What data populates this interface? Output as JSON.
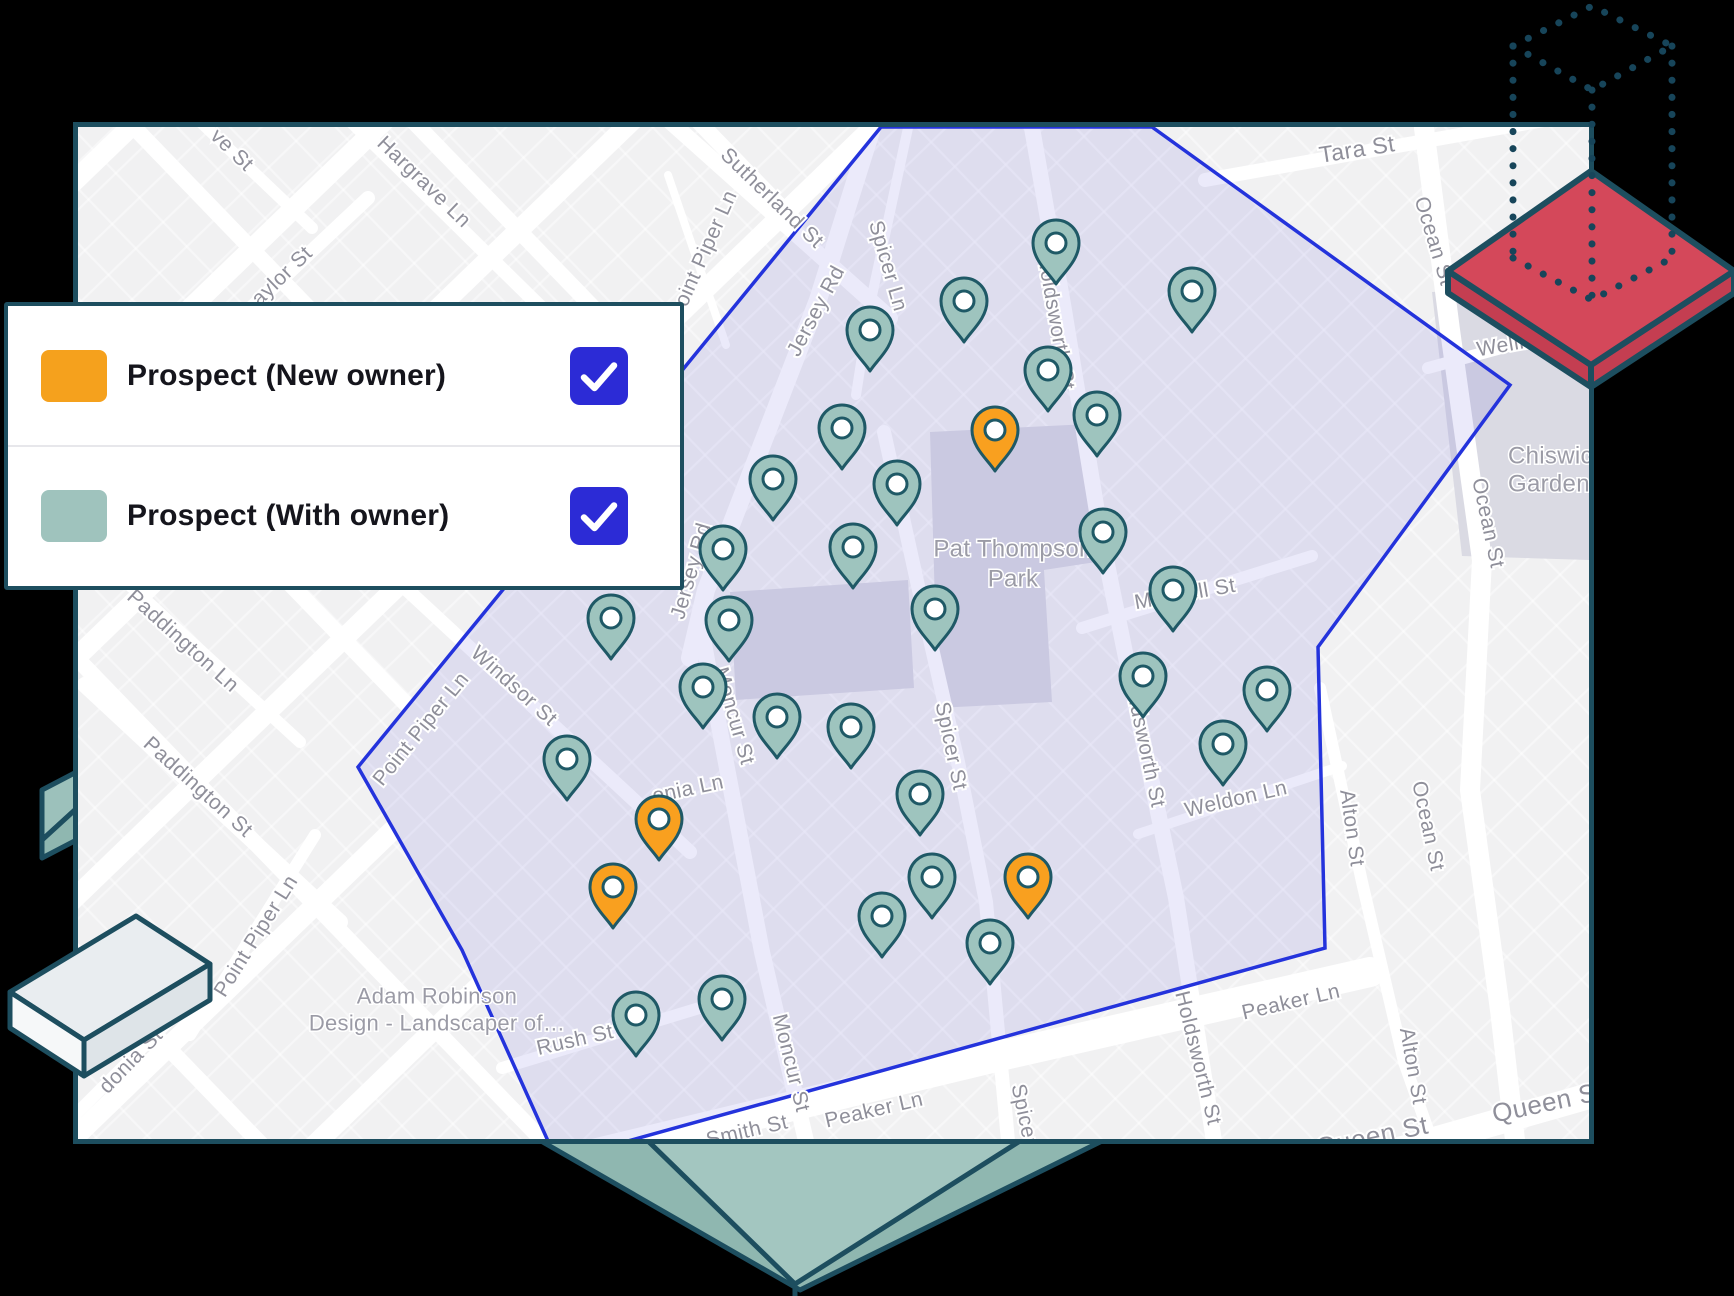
{
  "legend": {
    "items": [
      {
        "label": "Prospect (New owner)",
        "swatch_color": "#F5A11D",
        "checked": true
      },
      {
        "label": "Prospect (With owner)",
        "swatch_color": "#9FC3BD",
        "checked": true
      }
    ],
    "checkbox_color": "#2C2BD6",
    "checkmark_icon": "check"
  },
  "map": {
    "colors": {
      "base": "#F1F1F2",
      "road": "#FFFFFF",
      "park": "#DADAE3",
      "street_label": "#8F8F9A",
      "place_label": "#9B9BA6",
      "territory_fill": "rgba(98,92,216,0.13)",
      "territory_stroke": "#2433DC",
      "pin_with_owner": "#9EC4BE",
      "pin_new_owner": "#F9A01F",
      "pin_stroke": "#1F5966",
      "pin_hole": "#FFFFFF"
    },
    "territory_points": "881,127 358,767 462,950 548,1141 628,1141 1325,948 1318,647 1510,385 1152,127",
    "parks": [
      {
        "name": "pat-thompson-park",
        "points": "930,432 1088,424 1096,562 1044,570 1052,702 938,708"
      },
      {
        "name": "moncur-block",
        "points": "730,592 908,580 914,688 736,700"
      },
      {
        "name": "chiswick-gardens-block",
        "points": "1432,292 1589,282 1589,560 1462,556"
      }
    ],
    "roads": [
      {
        "pts": [
          [
            1205,
            180
          ],
          [
            1589,
            112
          ]
        ],
        "w": 14
      },
      {
        "pts": [
          [
            1424,
            128
          ],
          [
            1450,
            330
          ],
          [
            1482,
            560
          ],
          [
            1470,
            790
          ],
          [
            1500,
            1010
          ],
          [
            1515,
            1140
          ]
        ],
        "w": 20
      },
      {
        "pts": [
          [
            1300,
            1178
          ],
          [
            1589,
            1096
          ]
        ],
        "w": 26
      },
      {
        "pts": [
          [
            560,
            1162
          ],
          [
            1000,
            1056
          ],
          [
            1370,
            972
          ]
        ],
        "w": 30
      },
      {
        "pts": [
          [
            502,
            1068
          ],
          [
            706,
            1006
          ]
        ],
        "w": 12
      },
      {
        "pts": [
          [
            872,
            128
          ],
          [
            818,
            300
          ],
          [
            758,
            455
          ],
          [
            706,
            590
          ],
          [
            690,
            658
          ]
        ],
        "w": 18
      },
      {
        "pts": [
          [
            700,
            622
          ],
          [
            722,
            742
          ],
          [
            762,
            952
          ],
          [
            806,
            1141
          ]
        ],
        "w": 16
      },
      {
        "pts": [
          [
            908,
            128
          ],
          [
            870,
            305
          ],
          [
            856,
            395
          ]
        ],
        "w": 10
      },
      {
        "pts": [
          [
            884,
            432
          ],
          [
            926,
            622
          ],
          [
            958,
            762
          ],
          [
            986,
            902
          ],
          [
            1008,
            1141
          ]
        ],
        "w": 14
      },
      {
        "pts": [
          [
            1032,
            128
          ],
          [
            1064,
            310
          ],
          [
            1100,
            530
          ],
          [
            1140,
            726
          ],
          [
            1176,
            898
          ],
          [
            1214,
            1141
          ]
        ],
        "w": 16
      },
      {
        "pts": [
          [
            1138,
            834
          ],
          [
            1342,
            766
          ]
        ],
        "w": 10
      },
      {
        "pts": [
          [
            1082,
            628
          ],
          [
            1312,
            556
          ]
        ],
        "w": 12
      },
      {
        "pts": [
          [
            1428,
            368
          ],
          [
            1589,
            324
          ]
        ],
        "w": 12
      },
      {
        "pts": [
          [
            1320,
            688
          ],
          [
            1362,
            882
          ],
          [
            1404,
            1062
          ],
          [
            1432,
            1141
          ]
        ],
        "w": 12
      },
      {
        "pts": [
          [
            402,
            585
          ],
          [
            690,
            852
          ]
        ],
        "w": 14
      },
      {
        "pts": [
          [
            655,
            108
          ],
          [
            890,
            318
          ]
        ],
        "w": 16
      },
      {
        "pts": [
          [
            668,
            175
          ],
          [
            726,
            345
          ]
        ],
        "w": 8
      },
      {
        "pts": [
          [
            325,
            95
          ],
          [
            572,
            338
          ]
        ],
        "w": 14
      },
      {
        "pts": [
          [
            162,
            85
          ],
          [
            312,
            228
          ]
        ],
        "w": 12
      },
      {
        "pts": [
          [
            200,
            356
          ],
          [
            368,
            198
          ]
        ],
        "w": 14
      },
      {
        "pts": [
          [
            100,
            558
          ],
          [
            300,
            742
          ]
        ],
        "w": 12
      },
      {
        "pts": [
          [
            85,
            685
          ],
          [
            340,
            922
          ]
        ],
        "w": 16
      },
      {
        "pts": [
          [
            190,
            1035
          ],
          [
            315,
            835
          ]
        ],
        "w": 12
      },
      {
        "pts": [
          [
            70,
            1120
          ],
          [
            195,
            995
          ]
        ],
        "w": 12
      }
    ],
    "street_labels": [
      {
        "t": "ve St",
        "x": 232,
        "y": 150,
        "r": 44
      },
      {
        "t": "Hargrave Ln",
        "x": 424,
        "y": 182,
        "r": 44
      },
      {
        "t": "aylor St",
        "x": 282,
        "y": 276,
        "r": -44
      },
      {
        "t": "Sutherland St",
        "x": 772,
        "y": 198,
        "r": 44
      },
      {
        "t": "Point Piper Ln",
        "x": 703,
        "y": 255,
        "r": -66
      },
      {
        "t": "Spicer Ln",
        "x": 888,
        "y": 266,
        "r": 74
      },
      {
        "t": "Jersey Rd",
        "x": 816,
        "y": 311,
        "r": -62
      },
      {
        "t": "Holdsworth St",
        "x": 1056,
        "y": 322,
        "r": 80
      },
      {
        "t": "Tara St",
        "x": 1357,
        "y": 149,
        "r": -9,
        "fs": 23
      },
      {
        "t": "Ocean St",
        "x": 1434,
        "y": 241,
        "r": 73
      },
      {
        "t": "Wellington St",
        "x": 1477,
        "y": 350,
        "r": -10,
        "a": "s"
      },
      {
        "t": "Ocean St",
        "x": 1488,
        "y": 523,
        "r": 78
      },
      {
        "t": "Mitchell St",
        "x": 1185,
        "y": 594,
        "r": -10
      },
      {
        "t": "Jersey Rd",
        "x": 691,
        "y": 571,
        "r": -74
      },
      {
        "t": "Windsor St",
        "x": 514,
        "y": 686,
        "r": 42
      },
      {
        "t": "Point Piper Ln",
        "x": 421,
        "y": 729,
        "r": -51
      },
      {
        "t": "Paddington Ln",
        "x": 183,
        "y": 641,
        "r": 42
      },
      {
        "t": "Paddington St",
        "x": 198,
        "y": 787,
        "r": 42
      },
      {
        "t": "Point Piper Ln",
        "x": 256,
        "y": 936,
        "r": -58
      },
      {
        "t": "onia Ln",
        "x": 688,
        "y": 789,
        "r": -12
      },
      {
        "t": "donia St",
        "x": 131,
        "y": 1061,
        "r": -46
      },
      {
        "t": "Moncur St",
        "x": 734,
        "y": 716,
        "r": 74
      },
      {
        "t": "Spicer St",
        "x": 951,
        "y": 746,
        "r": 78
      },
      {
        "t": "Weldon Ln",
        "x": 1236,
        "y": 799,
        "r": -13
      },
      {
        "t": "Holdsworth St",
        "x": 1144,
        "y": 740,
        "r": 78
      },
      {
        "t": "Holdsworth St",
        "x": 1198,
        "y": 1058,
        "r": 76
      },
      {
        "t": "Ocean St",
        "x": 1428,
        "y": 826,
        "r": 78
      },
      {
        "t": "Alton St",
        "x": 1352,
        "y": 828,
        "r": 82
      },
      {
        "t": "Alton St",
        "x": 1413,
        "y": 1066,
        "r": 80
      },
      {
        "t": "Peaker Ln",
        "x": 874,
        "y": 1110,
        "r": -13
      },
      {
        "t": "Peaker Ln",
        "x": 1291,
        "y": 1002,
        "r": -13
      },
      {
        "t": "Smith St",
        "x": 747,
        "y": 1131,
        "r": -13
      },
      {
        "t": "Rush St",
        "x": 575,
        "y": 1040,
        "r": -13
      },
      {
        "t": "Queen St",
        "x": 1548,
        "y": 1102,
        "r": -12,
        "fs": 26
      },
      {
        "t": "Queen St",
        "x": 1372,
        "y": 1136,
        "r": -12,
        "fs": 26
      },
      {
        "t": "Spicer St",
        "x": 1027,
        "y": 1128,
        "r": 78
      },
      {
        "t": "Moncur St",
        "x": 791,
        "y": 1063,
        "r": 76
      }
    ],
    "place_labels": [
      {
        "t": "Pat Thompson",
        "x": 1013,
        "y": 549
      },
      {
        "t": "Park",
        "x": 1013,
        "y": 579
      },
      {
        "t": "Chiswick",
        "x": 1508,
        "y": 456,
        "a": "s"
      },
      {
        "t": "Gardens",
        "x": 1508,
        "y": 484,
        "a": "s"
      },
      {
        "t": "Adam Robinson",
        "x": 437,
        "y": 996,
        "fs": 22
      },
      {
        "t": "Design - Landscaper of…",
        "x": 437,
        "y": 1023,
        "fs": 22
      }
    ],
    "pins": {
      "new_owner": [
        [
          995,
          430
        ],
        [
          659,
          819
        ],
        [
          613,
          887
        ],
        [
          1028,
          877
        ]
      ],
      "with_owner": [
        [
          870,
          330
        ],
        [
          964,
          301
        ],
        [
          1056,
          243
        ],
        [
          1192,
          291
        ],
        [
          1048,
          370
        ],
        [
          842,
          428
        ],
        [
          1097,
          415
        ],
        [
          773,
          479
        ],
        [
          897,
          484
        ],
        [
          723,
          549
        ],
        [
          853,
          547
        ],
        [
          935,
          609
        ],
        [
          1103,
          532
        ],
        [
          611,
          618
        ],
        [
          729,
          620
        ],
        [
          703,
          687
        ],
        [
          777,
          717
        ],
        [
          851,
          727
        ],
        [
          567,
          759
        ],
        [
          920,
          794
        ],
        [
          1173,
          590
        ],
        [
          1143,
          676
        ],
        [
          1267,
          690
        ],
        [
          1223,
          744
        ],
        [
          932,
          877
        ],
        [
          882,
          916
        ],
        [
          990,
          943
        ],
        [
          636,
          1015
        ],
        [
          722,
          999
        ]
      ]
    }
  },
  "decorations": {
    "outline_color": "#1D4E5F",
    "dot_color": "#17455A",
    "red_diamond": {
      "fill": "#D4485A",
      "side": "#C43E51"
    },
    "teal_diamond": {
      "fill": "#8FB7B0",
      "inner": "#A3C6C0"
    },
    "teal_box": {
      "fill": "#9CC1BB",
      "side": "#8FB7B0"
    },
    "gray_box": {
      "top": "#E9EDF0",
      "left": "#F6F8F9",
      "right": "#DEE4E8"
    }
  }
}
